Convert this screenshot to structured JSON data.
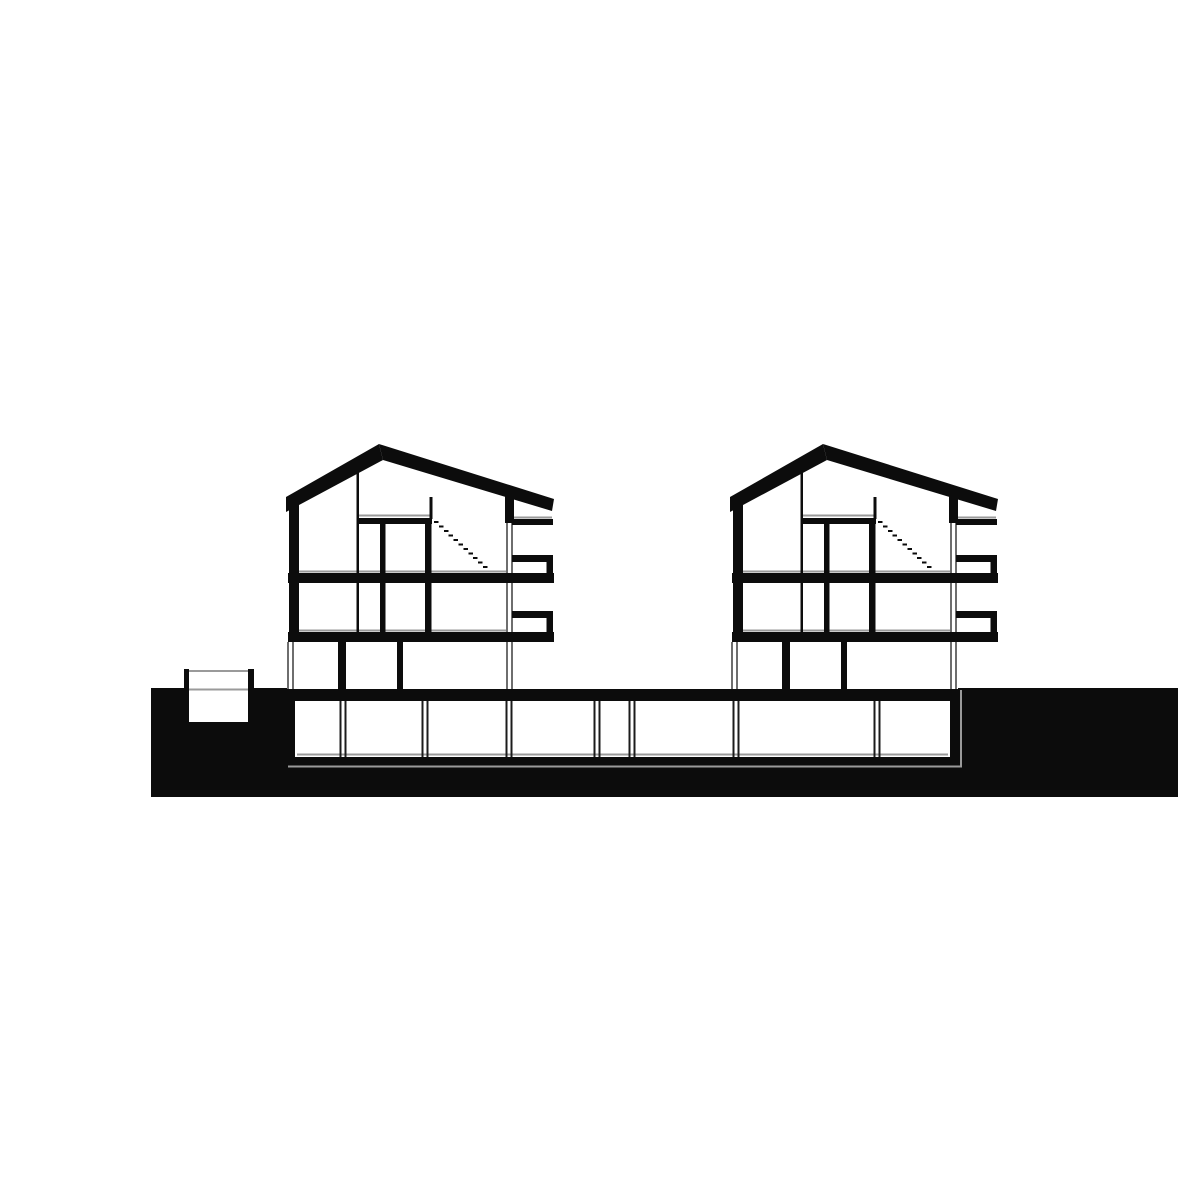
{
  "meta": {
    "drawing_type": "architectural-cross-section",
    "canvas": {
      "width": 1181,
      "height": 1181
    },
    "colors": {
      "paper": "#ffffff",
      "ink": "#0c0c0c",
      "finish_line": "#9a9a9a",
      "glass_line": "#6e6e6e",
      "partition_line": "#1c1c1c"
    }
  },
  "site": {
    "ink_rects": [
      {
        "name": "ground-mass-left",
        "r": [
          151,
          688,
          137,
          109
        ]
      },
      {
        "name": "ground-mass-right",
        "r": [
          958,
          688,
          220,
          109
        ]
      },
      {
        "name": "ground-mass-below-basement",
        "r": [
          288,
          757,
          670,
          40
        ]
      },
      {
        "name": "basement-ceiling-slab",
        "r": [
          288,
          689,
          670,
          12
        ]
      },
      {
        "name": "basement-wall-left",
        "r": [
          288,
          701,
          7,
          56
        ]
      },
      {
        "name": "basement-wall-right",
        "r": [
          950,
          701,
          8,
          56
        ]
      },
      {
        "name": "basement-wall-mid",
        "r": [
          783,
          701,
          8,
          56
        ]
      },
      {
        "name": "lightwell-wall-left",
        "r": [
          184,
          669,
          5,
          53
        ]
      },
      {
        "name": "lightwell-wall-right",
        "r": [
          248,
          669,
          6,
          53
        ]
      }
    ],
    "white_rects": [
      {
        "name": "basement-interior",
        "r": [
          295,
          701,
          655,
          56
        ]
      },
      {
        "name": "lightwell-interior",
        "r": [
          189,
          670,
          59,
          52
        ]
      }
    ],
    "gray_lines": [
      {
        "name": "lightwell-top-rail-line",
        "p": [
          189,
          671,
          248,
          671
        ]
      },
      {
        "name": "lightwell-ground-line",
        "p": [
          189,
          689.5,
          248,
          689.5
        ]
      },
      {
        "name": "excavation-line-bottom",
        "p": [
          288,
          766.5,
          962,
          766.5
        ]
      },
      {
        "name": "excavation-line-right",
        "p": [
          961,
          690,
          961,
          766
        ]
      },
      {
        "name": "basement-floor-finish-line",
        "p": [
          297,
          754.5,
          948,
          754.5
        ]
      }
    ],
    "basement_partitions": {
      "name": "basement-partition-double-line",
      "y1": 701,
      "y2": 757,
      "cx_list": [
        343,
        425,
        509,
        597,
        632,
        736,
        877
      ]
    }
  },
  "houses": {
    "offsets": [
      0,
      444
    ],
    "ink_polys": [
      {
        "name": "roof-left-slope",
        "pts": [
          [
            286,
            497
          ],
          [
            286,
            512
          ],
          [
            383,
            460
          ],
          [
            379,
            444
          ]
        ]
      },
      {
        "name": "roof-right-slope",
        "pts": [
          [
            379,
            444
          ],
          [
            554,
            499
          ],
          [
            552,
            511
          ],
          [
            383,
            460
          ]
        ]
      }
    ],
    "ink_rects": [
      {
        "name": "exterior-wall-left",
        "r": [
          289,
          500,
          10,
          142
        ]
      },
      {
        "name": "attic-terrace-wall",
        "r": [
          505,
          492,
          9,
          31
        ]
      },
      {
        "name": "attic-terrace-slab",
        "r": [
          512,
          519,
          41,
          6
        ]
      },
      {
        "name": "balcony-rail-upper-cap",
        "r": [
          512,
          555,
          35,
          7
        ]
      },
      {
        "name": "balcony-rail-upper-post",
        "r": [
          546.5,
          555,
          6.5,
          28
        ]
      },
      {
        "name": "floor-slab-upper",
        "r": [
          288,
          573,
          266,
          10
        ]
      },
      {
        "name": "balcony-rail-lower-cap",
        "r": [
          512,
          611,
          35,
          7
        ]
      },
      {
        "name": "balcony-rail-lower-post",
        "r": [
          546.5,
          611,
          6.5,
          31
        ]
      },
      {
        "name": "floor-slab-ground",
        "r": [
          288,
          632,
          266,
          10
        ]
      },
      {
        "name": "attic-floor-slab",
        "r": [
          357,
          518,
          75,
          6
        ]
      },
      {
        "name": "interior-wall-thin",
        "r": [
          356.5,
          468,
          2.5,
          165
        ]
      },
      {
        "name": "interior-wall-a",
        "r": [
          380,
          524,
          5.5,
          108
        ]
      },
      {
        "name": "interior-wall-b",
        "r": [
          425,
          524,
          6.5,
          108
        ]
      },
      {
        "name": "stair-guard-wall",
        "r": [
          429.5,
          497,
          3,
          22
        ]
      },
      {
        "name": "garden-level-wall-a",
        "r": [
          338,
          642,
          8,
          47
        ]
      },
      {
        "name": "garden-level-wall-b",
        "r": [
          397,
          642,
          6,
          47
        ]
      }
    ],
    "glass_double_lines": [
      {
        "name": "facade-glass-line",
        "cx": 509.5,
        "y1": 523,
        "y2": 689
      },
      {
        "name": "garden-level-glass-left",
        "cx": 290.5,
        "y1": 642,
        "y2": 689
      }
    ],
    "gray_lines": [
      {
        "name": "floor-finish-attic",
        "p": [
          359,
          515.5,
          430,
          515.5
        ]
      },
      {
        "name": "floor-finish-upper",
        "p": [
          299,
          571.5,
          506,
          571.5
        ]
      },
      {
        "name": "floor-finish-ground",
        "p": [
          299,
          630.5,
          506,
          630.5
        ]
      },
      {
        "name": "terrace-finish",
        "p": [
          513,
          517.5,
          552,
          517.5
        ]
      }
    ],
    "stair_dashes": {
      "name": "stair-dashed-line",
      "from": [
        434,
        521
      ],
      "count": 11,
      "step": [
        4.9,
        4.5
      ],
      "dash": [
        4.5,
        2.2
      ]
    }
  }
}
